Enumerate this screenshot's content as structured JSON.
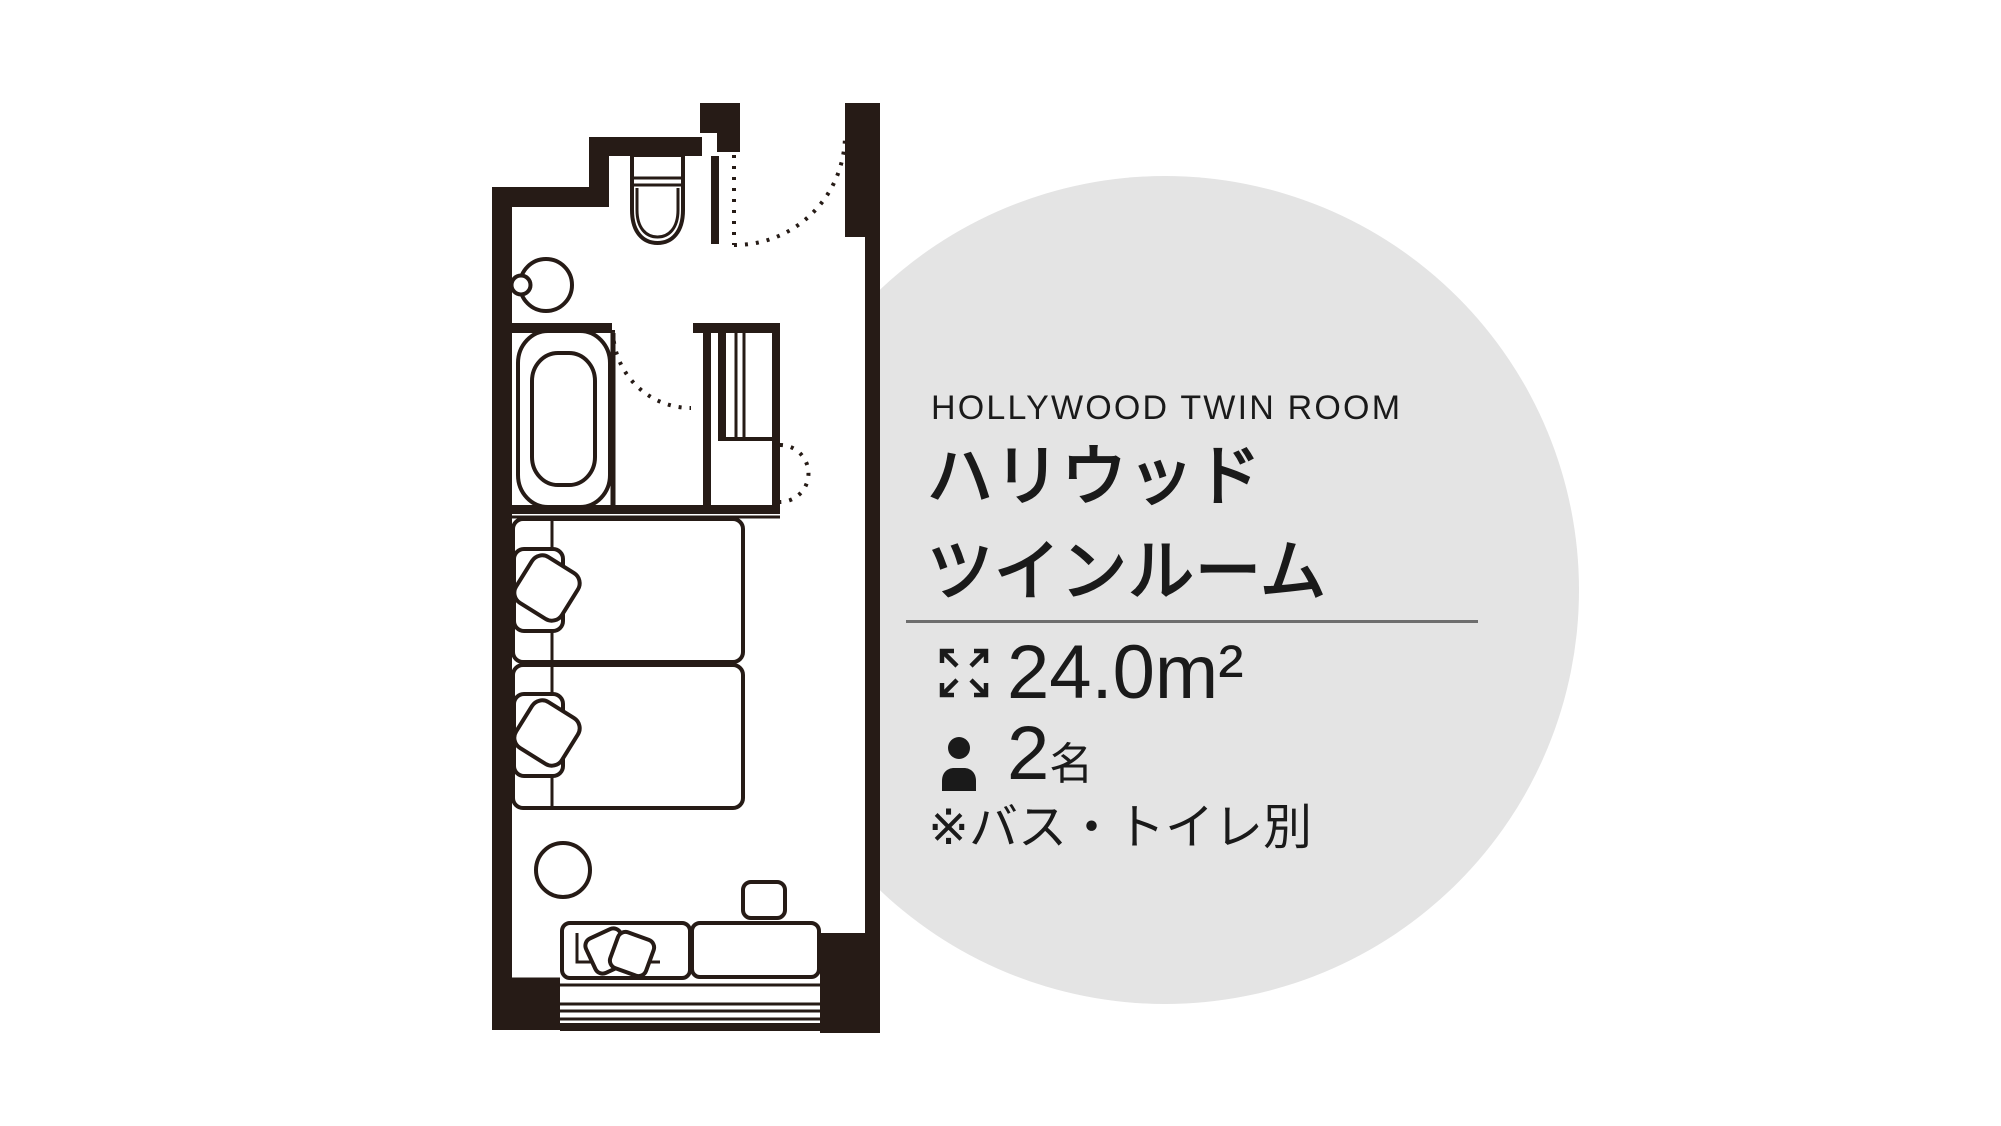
{
  "page": {
    "background": "#ffffff"
  },
  "room_card": {
    "badge_circle_color": "#e4e4e4",
    "text_color": "#1a1a1a",
    "divider_color": "#6e6e6e",
    "title_en": "HOLLYWOOD TWIN ROOM",
    "title_ja": [
      "ハリウッド",
      "ツインルーム"
    ],
    "specs": [
      {
        "icon": "expand-arrows-icon",
        "value": "24.0",
        "unit": "m²"
      },
      {
        "icon": "person-icon",
        "value": "2",
        "unit": "名"
      }
    ],
    "note": "※バス・トイレ別"
  },
  "floor_plan": {
    "name": "hollywood-twin-room-floor-plan",
    "line_color": "#261b16",
    "features": [
      "entrance-door",
      "toilet",
      "washbasin",
      "bathtub",
      "closet",
      "twin-beds",
      "bedside-chairs",
      "round-table",
      "sofa",
      "cushions",
      "side-table",
      "window"
    ]
  }
}
